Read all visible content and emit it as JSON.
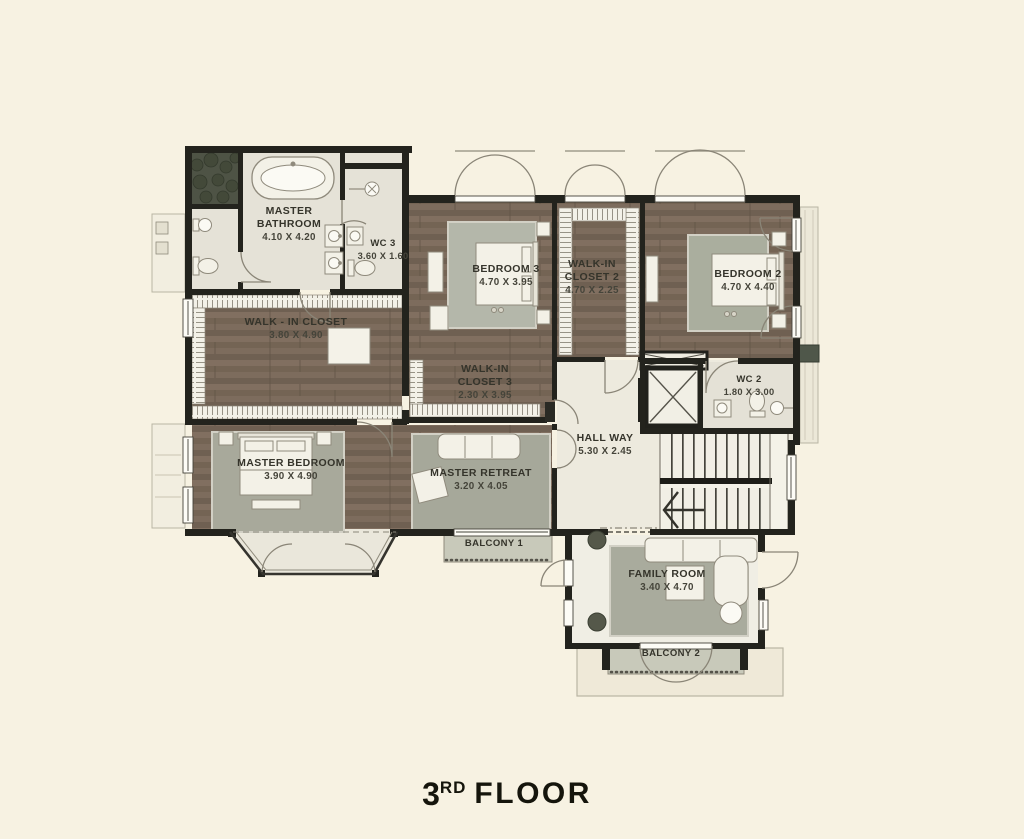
{
  "title": {
    "number": "3",
    "ordinal": "RD",
    "word": "FLOOR"
  },
  "rooms": [
    {
      "id": "master-bathroom",
      "name": "MASTER BATHROOM",
      "dims": "4.10 X 4.20"
    },
    {
      "id": "wc-3",
      "name": "WC 3",
      "dims": "3.60 X 1.60"
    },
    {
      "id": "walk-in-closet",
      "name": "WALK - IN CLOSET",
      "dims": "3.80 X 4.90"
    },
    {
      "id": "bedroom-3",
      "name": "BEDROOM 3",
      "dims": "4.70 X 3.95"
    },
    {
      "id": "walk-in-closet-2",
      "name": "WALK-IN CLOSET 2",
      "dims": "4.70 X 2.25"
    },
    {
      "id": "bedroom-2",
      "name": "BEDROOM 2",
      "dims": "4.70 X 4.40"
    },
    {
      "id": "walk-in-closet-3",
      "name": "WALK-IN CLOSET 3",
      "dims": "2.30 X 3.95"
    },
    {
      "id": "wc-2",
      "name": "WC 2",
      "dims": "1.80 X 3.00"
    },
    {
      "id": "hall-way",
      "name": "HALL WAY",
      "dims": "5.30 X 2.45"
    },
    {
      "id": "master-bedroom",
      "name": "MASTER BEDROOM",
      "dims": "3.90 X 4.90"
    },
    {
      "id": "master-retreat",
      "name": "MASTER RETREAT",
      "dims": "3.20 X 4.05"
    },
    {
      "id": "balcony-1",
      "name": "BALCONY 1",
      "dims": ""
    },
    {
      "id": "family-room",
      "name": "FAMILY ROOM",
      "dims": "3.40 X 4.70"
    },
    {
      "id": "balcony-2",
      "name": "BALCONY 2",
      "dims": ""
    }
  ],
  "colors": {
    "background": "#f7f2e2",
    "walls": "#23231d",
    "wood_floor": "#7a695b",
    "marble_floor": "#e5e2d7",
    "rug": "#a9ab9d",
    "balcony_floor": "#c8c9ba",
    "label_text": "#35342b",
    "title_text": "#15150c"
  }
}
